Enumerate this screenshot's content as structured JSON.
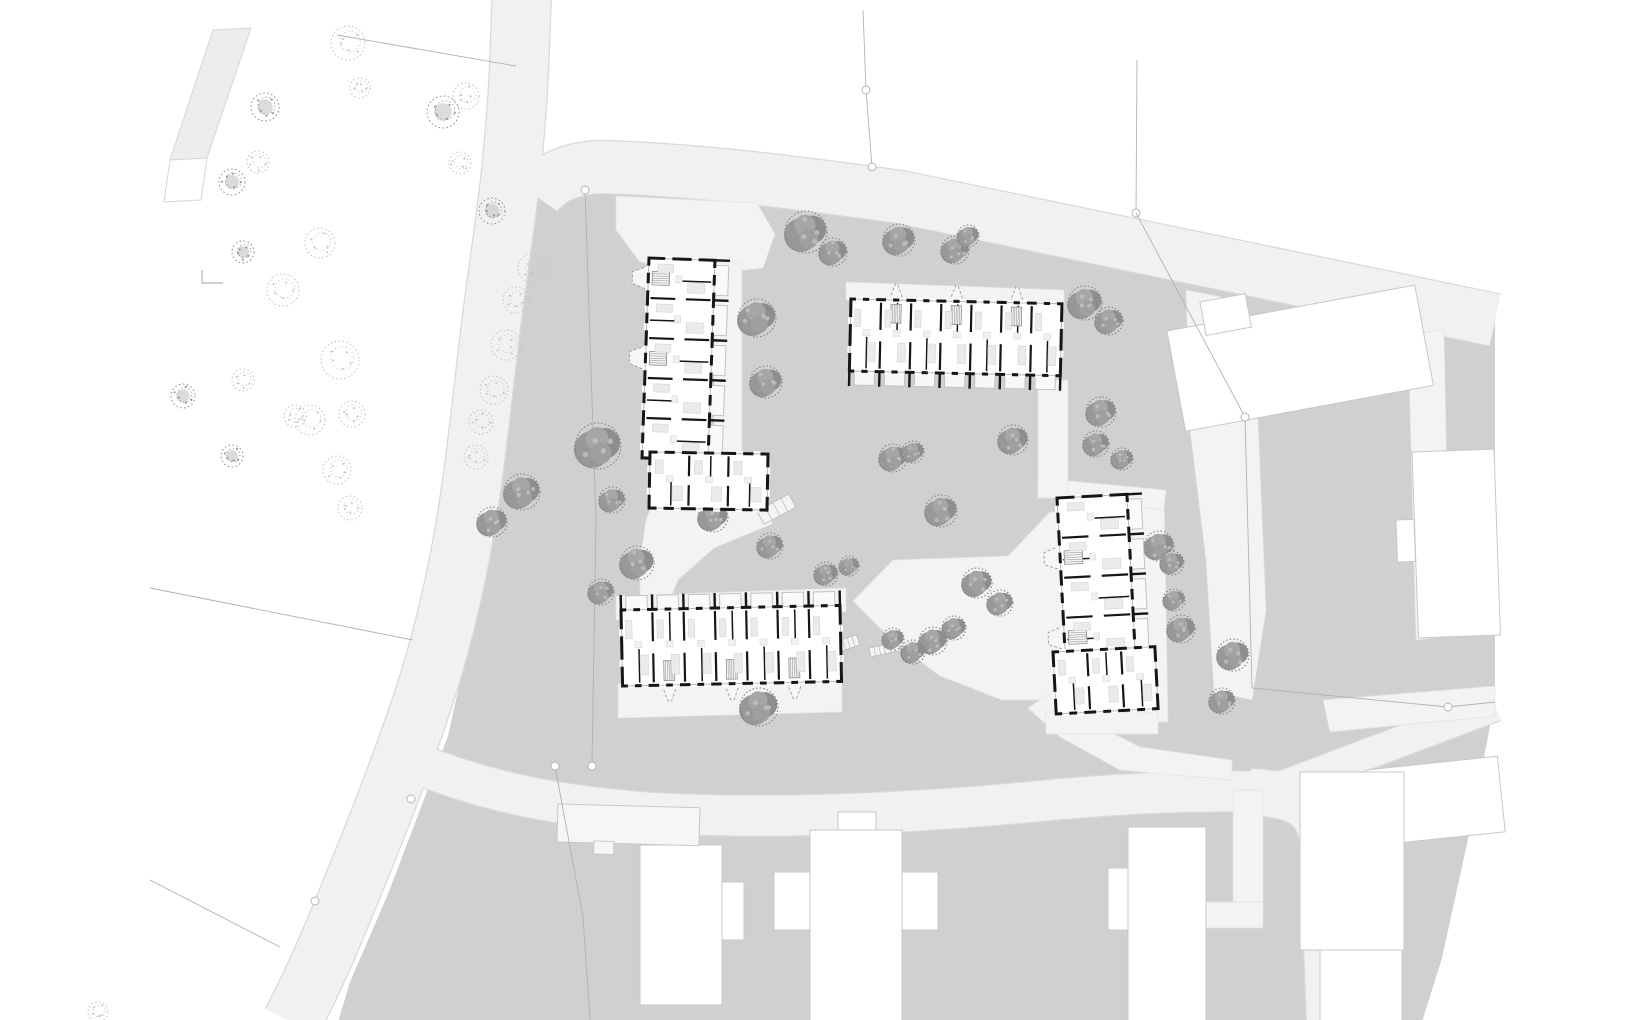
{
  "meta": {
    "type": "architectural-site-plan",
    "canvas": {
      "w": 1640,
      "h": 1020
    }
  },
  "colors": {
    "bg": "#ffffff",
    "ground": "#d0d0d1",
    "road": "#f1f1f2",
    "roadCasing": "#d9d9db",
    "path": "#f3f3f4",
    "pathStroke": "#e2e2e4",
    "parkStrip": "#ededee",
    "parkStripStroke": "#d6d6d8",
    "ctxFill": "#ffffff",
    "ctxStroke": "#c8c8ca",
    "ctxLight": "#f6f6f6",
    "wall": "#161616",
    "bldgFill": "#ffffff",
    "furn": "#ebebeb",
    "furnStroke": "#d4d4d6",
    "balcony": "#c2c2c4",
    "porch": "#9b9b9d",
    "stair": "#8d8d8f",
    "boundary": "#b2b2b5",
    "glass": "#b8b8ba",
    "treeSiteA": "#989898",
    "treeSiteB": "#8e8e8e",
    "treeSiteC": "#a6a6a6",
    "treeSiteD": "#9f9f9f",
    "treeSiteEdge": "#7d7d7d",
    "treeSiteLight": "#c2c2c2",
    "treePark": "#c3c3c5",
    "treeParkDark": "#8f8f91"
  },
  "ground": {
    "pts": "545,172 700,196 900,223 1135,252 1300,282 1495,312 1495,700 1470,830 1442,958 1422,1022 338,1022 350,982 388,894 426,794 448,736 468,645 488,540 500,445 510,350 517,278 524,238 535,212"
  },
  "park_strip": {
    "strip": "213,30 251,28 207,158 170,160",
    "box": "170,160 207,158 201,200 164,202",
    "corner_mark": "202,270 202,283 223,283"
  },
  "roads": [
    {
      "name": "road-north-south",
      "d": "M 522 -10 L 519 70 C 515 150 507 210 497 280 C 487 350 481 420 471 490 C 461 560 445 635 421 706 C 397 778 365 858 327 948 C 311 985 301 1004 292 1022",
      "width": 58
    },
    {
      "name": "road-east-west",
      "d": "M 536 196 Q 556 168 602 167 C 700 170 800 183 900 197 L 1495 320",
      "width": 52
    },
    {
      "name": "road-south",
      "d": "M 428 768 C 500 795 560 805 640 812 C 760 820 900 814 1030 802 C 1120 793 1200 790 1268 792",
      "width": 40
    },
    {
      "name": "road-south-turn",
      "d": "M 1250 792 C 1295 794 1318 804 1323 840 L 1330 1022",
      "width": 46
    },
    {
      "name": "path-southeast",
      "d": "M 1272 790 L 1495 706",
      "width": 30
    }
  ],
  "paths": [
    {
      "name": "entry-plaza",
      "pts": "616,196 757,203 775,234 763,268 700,275 640,262 616,230"
    },
    {
      "name": "path-a-to-c",
      "pts": "652,505 772,505 772,524 714,548 678,580 664,614 640,614 640,560 646,520"
    },
    {
      "name": "path-north-of-c",
      "pts": "616,596 846,588 846,612 616,620"
    },
    {
      "name": "central-plaza",
      "pts": "853,601 893,560 1008,556 1050,512 1062,512 1062,700 1002,700 940,676 893,641"
    },
    {
      "name": "path-to-south-road",
      "pts": "1055,690 1090,722 1140,747 1232,760 1232,780 1120,770 1060,737 1028,708"
    },
    {
      "name": "path-east-of-d",
      "pts": "1128,490 1164,490 1168,722 1132,722"
    },
    {
      "name": "path-north-of-d",
      "pts": "1038,478 1166,490 1164,510 1038,496"
    },
    {
      "name": "path-b-to-d",
      "pts": "1038,380 1068,380 1068,498 1038,498"
    },
    {
      "name": "path-east-of-a",
      "pts": "714,262 742,262 742,462 714,462"
    },
    {
      "name": "path-north-of-b",
      "pts": "846,282 1064,290 1064,308 846,300"
    },
    {
      "name": "path-south-of-c",
      "pts": "618,684 842,678 842,712 618,718"
    },
    {
      "name": "path-south-of-d-wing",
      "pts": "1046,712 1158,712 1158,734 1046,734"
    },
    {
      "name": "strip-east-boundary",
      "pts": "1186,290 1222,297 1258,420 1266,610 1252,700 1214,692 1206,560 1190,430"
    },
    {
      "name": "strip-east-parcel",
      "pts": "1408,334 1444,330 1450,636 1416,640"
    },
    {
      "name": "strip-northeast-walk",
      "pts": "1323,700 1495,686 1495,716 1330,732"
    },
    {
      "name": "walk-southeast-a",
      "pts": "1233,790 1263,790 1263,912 1233,912"
    },
    {
      "name": "walk-southeast-b",
      "pts": "1128,902 1263,902 1263,928 1128,928"
    }
  ],
  "context_buildings": [
    {
      "name": "context-east-slab",
      "x": 1167,
      "y": 331,
      "w": 252,
      "h": 102,
      "rot": -10.5
    },
    {
      "name": "context-east-slab-step",
      "x": 1200,
      "y": 302,
      "w": 46,
      "h": 34,
      "rot": -10.5
    },
    {
      "name": "context-east-tower",
      "x": 1412,
      "y": 452,
      "w": 82,
      "h": 186,
      "rot": -2
    },
    {
      "name": "context-east-tower-step",
      "x": 1396,
      "y": 520,
      "w": 18,
      "h": 42,
      "rot": -2
    },
    {
      "name": "context-southeast-corner",
      "x": 1366,
      "y": 770,
      "w": 132,
      "h": 76,
      "rot": -6
    },
    {
      "name": "context-south-cross-main",
      "x": 810,
      "y": 830,
      "w": 92,
      "h": 192,
      "rot": 0
    },
    {
      "name": "context-south-cross-west",
      "x": 774,
      "y": 872,
      "w": 36,
      "h": 58,
      "rot": 0
    },
    {
      "name": "context-south-cross-east",
      "x": 902,
      "y": 872,
      "w": 36,
      "h": 58,
      "rot": 0
    },
    {
      "name": "context-south-cross-top",
      "x": 838,
      "y": 812,
      "w": 38,
      "h": 18,
      "rot": 0
    },
    {
      "name": "context-south-west",
      "x": 640,
      "y": 845,
      "w": 82,
      "h": 160,
      "rot": 0
    },
    {
      "name": "context-south-west-step",
      "x": 722,
      "y": 882,
      "w": 22,
      "h": 58,
      "rot": 0
    },
    {
      "name": "context-south-mid",
      "x": 1128,
      "y": 827,
      "w": 78,
      "h": 196,
      "rot": 0
    },
    {
      "name": "context-south-mid-step",
      "x": 1108,
      "y": 868,
      "w": 20,
      "h": 62,
      "rot": 0
    },
    {
      "name": "context-south-east",
      "x": 1300,
      "y": 772,
      "w": 104,
      "h": 178,
      "rot": 0
    },
    {
      "name": "context-south-east-lower",
      "x": 1320,
      "y": 950,
      "w": 82,
      "h": 74,
      "rot": 0
    }
  ],
  "light_buildings": [
    {
      "name": "roadside-shed",
      "x": 558,
      "y": 804,
      "w": 142,
      "h": 38,
      "rot": 1.5
    },
    {
      "name": "roadside-shed-step",
      "x": 594,
      "y": 841,
      "w": 20,
      "h": 13,
      "rot": 1.5
    }
  ],
  "boundaries": [
    {
      "name": "park-line-north",
      "pts": "337,35 516,66",
      "circles": []
    },
    {
      "name": "parcel-line-north",
      "pts": "863,10 866,90 872,167",
      "circles": [
        [
          866,
          90
        ],
        [
          872,
          167
        ]
      ]
    },
    {
      "name": "parcel-line-northeast",
      "pts": "1137,60 1136,213",
      "circles": [
        [
          1136,
          213
        ]
      ]
    },
    {
      "name": "site-line-west",
      "pts": "585,190 596,520 592,766",
      "circles": [
        [
          585,
          190
        ],
        [
          592,
          766
        ]
      ]
    },
    {
      "name": "site-line-southwest",
      "pts": "555,766 583,917 590,1020",
      "circles": [
        [
          555,
          766
        ]
      ]
    },
    {
      "name": "site-line-east",
      "pts": "1136,213 1245,417 1252,688 1448,707 1495,702",
      "circles": [
        [
          1245,
          417
        ],
        [
          1448,
          707
        ]
      ]
    },
    {
      "name": "park-line-mid",
      "pts": "150,588 413,640",
      "circles": [
        [
          411,
          799
        ]
      ]
    },
    {
      "name": "park-line-south",
      "pts": "150,880 280,947",
      "circles": [
        [
          315,
          901
        ]
      ]
    }
  ],
  "steps": [
    {
      "x": 828,
      "y": 644,
      "w": 30,
      "h": 11,
      "rot": -18,
      "n": 6
    },
    {
      "x": 869,
      "y": 648,
      "w": 30,
      "h": 9,
      "rot": -12,
      "n": 6
    },
    {
      "x": 757,
      "y": 511,
      "w": 36,
      "h": 15,
      "rot": -28,
      "n": 4
    }
  ],
  "trees_park": [
    [
      265,
      107,
      14,
      1
    ],
    [
      348,
      43,
      17,
      0
    ],
    [
      360,
      88,
      10,
      0
    ],
    [
      443,
      112,
      16,
      1
    ],
    [
      466,
      96,
      13,
      0
    ],
    [
      232,
      182,
      13,
      1
    ],
    [
      258,
      162,
      11,
      0
    ],
    [
      320,
      243,
      15,
      0
    ],
    [
      283,
      290,
      16,
      0
    ],
    [
      243,
      252,
      11,
      1
    ],
    [
      460,
      163,
      11,
      0
    ],
    [
      492,
      211,
      13,
      1
    ],
    [
      533,
      268,
      15,
      0
    ],
    [
      516,
      300,
      13,
      0
    ],
    [
      506,
      345,
      15,
      0
    ],
    [
      494,
      390,
      14,
      0
    ],
    [
      481,
      422,
      12,
      0
    ],
    [
      476,
      457,
      12,
      0
    ],
    [
      340,
      360,
      19,
      0
    ],
    [
      310,
      420,
      15,
      0
    ],
    [
      352,
      414,
      13,
      0
    ],
    [
      183,
      396,
      12,
      1
    ],
    [
      243,
      380,
      11,
      0
    ],
    [
      295,
      416,
      11,
      0
    ],
    [
      232,
      456,
      11,
      1
    ],
    [
      337,
      470,
      14,
      0
    ],
    [
      350,
      508,
      12,
      0
    ],
    [
      98,
      1012,
      10,
      0
    ]
  ],
  "trees_site": [
    [
      806,
      232,
      21
    ],
    [
      833,
      252,
      14
    ],
    [
      899,
      240,
      16
    ],
    [
      955,
      250,
      14
    ],
    [
      968,
      236,
      11
    ],
    [
      1085,
      303,
      17
    ],
    [
      1109,
      321,
      14
    ],
    [
      757,
      318,
      19
    ],
    [
      766,
      382,
      16
    ],
    [
      598,
      446,
      23
    ],
    [
      522,
      492,
      18
    ],
    [
      492,
      522,
      15
    ],
    [
      612,
      500,
      13
    ],
    [
      637,
      563,
      17
    ],
    [
      601,
      592,
      13
    ],
    [
      713,
      517,
      15
    ],
    [
      770,
      546,
      13
    ],
    [
      893,
      458,
      14
    ],
    [
      913,
      452,
      11
    ],
    [
      1013,
      440,
      15
    ],
    [
      941,
      511,
      16
    ],
    [
      1101,
      412,
      15
    ],
    [
      1096,
      444,
      13
    ],
    [
      1122,
      459,
      11
    ],
    [
      826,
      574,
      12
    ],
    [
      849,
      566,
      10
    ],
    [
      977,
      583,
      15
    ],
    [
      1000,
      603,
      13
    ],
    [
      954,
      628,
      12
    ],
    [
      933,
      641,
      14
    ],
    [
      913,
      652,
      12
    ],
    [
      893,
      639,
      11
    ],
    [
      759,
      707,
      19
    ],
    [
      1159,
      546,
      15
    ],
    [
      1172,
      563,
      12
    ],
    [
      1181,
      629,
      14
    ],
    [
      1174,
      600,
      11
    ],
    [
      1233,
      655,
      16
    ],
    [
      1222,
      701,
      13
    ]
  ],
  "buildings": [
    {
      "id": "building-a",
      "x": 649,
      "y": 258,
      "w": 66,
      "h": 200,
      "rot": 2,
      "orient": "v",
      "bays": 5,
      "porch": "near",
      "balc": "far",
      "porchBays": [
        0,
        2
      ]
    },
    {
      "id": "building-a-wing",
      "x": 650,
      "y": 452,
      "w": 118,
      "h": 56,
      "rot": 1,
      "orient": "h",
      "bays": 3,
      "porch": null,
      "balc": null,
      "porchBays": []
    },
    {
      "id": "building-b",
      "x": 851,
      "y": 299,
      "w": 211,
      "h": 72,
      "rot": 1.3,
      "orient": "h",
      "bays": 7,
      "porch": "near",
      "balc": "far",
      "porchBays": [
        1,
        3,
        5
      ]
    },
    {
      "id": "building-c",
      "x": 621,
      "y": 610,
      "w": 219,
      "h": 76,
      "rot": -1.2,
      "orient": "h",
      "bays": 7,
      "porch": "far",
      "balc": "near",
      "porchBays": [
        1,
        3,
        5
      ]
    },
    {
      "id": "building-d",
      "x": 1057,
      "y": 498,
      "w": 70,
      "h": 160,
      "rot": -3,
      "orient": "v",
      "bays": 4,
      "porch": "near",
      "balc": "far",
      "porchBays": [
        1,
        3
      ]
    },
    {
      "id": "building-d-wing",
      "x": 1053,
      "y": 652,
      "w": 102,
      "h": 62,
      "rot": -3,
      "orient": "h",
      "bays": 3,
      "porch": null,
      "balc": null,
      "porchBays": []
    }
  ]
}
